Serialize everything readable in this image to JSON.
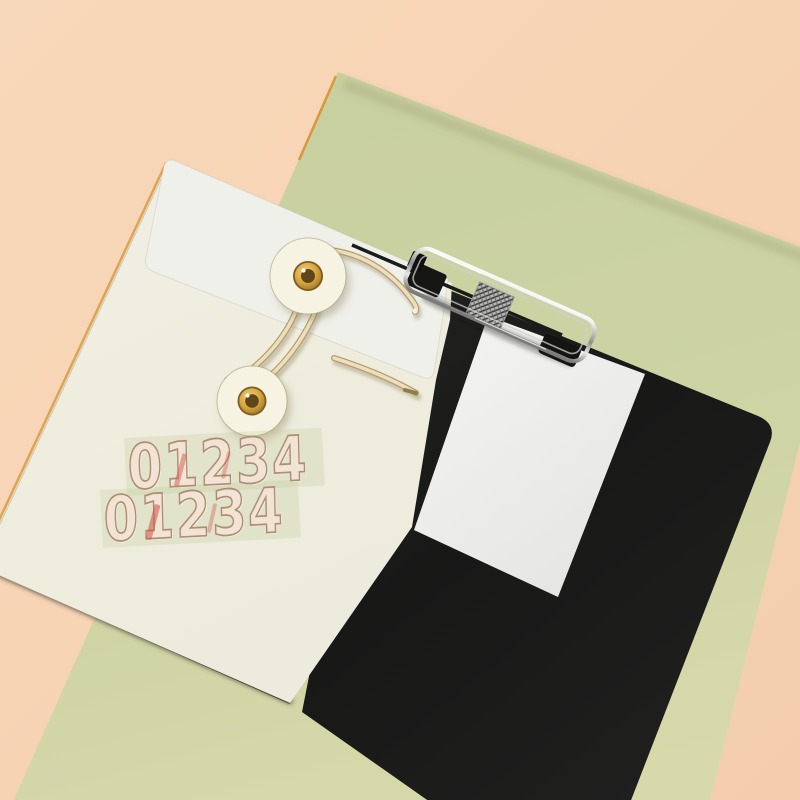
{
  "photo": {
    "description": "Flat-lay product photo: cream string-tie envelope with gold grommet buttons and number stickers, black clipboard folder with metal clip and blank white paper, on a green paper sheet over a peach background",
    "colors": {
      "background_peach": "#f6d3b3",
      "green_sheet": "#cbd1a1",
      "envelope_cream": "#efeee2",
      "envelope_flap": "#f0f0eb",
      "black_folder": "#1d1d1b",
      "white_paper": "#f0f0ee",
      "grommet_gold": "#d2a13c",
      "string": "#e9dcb9",
      "rim_light_orange": "#df9f49",
      "sticker_fill": "rgba(243,216,196,0.55)",
      "sticker_outline": "rgba(172,135,110,0.95)",
      "sticker_red_accent": "rgba(208,90,78,0.5)"
    },
    "sticker_rows": {
      "row1": "01234",
      "row2": "01234"
    }
  }
}
